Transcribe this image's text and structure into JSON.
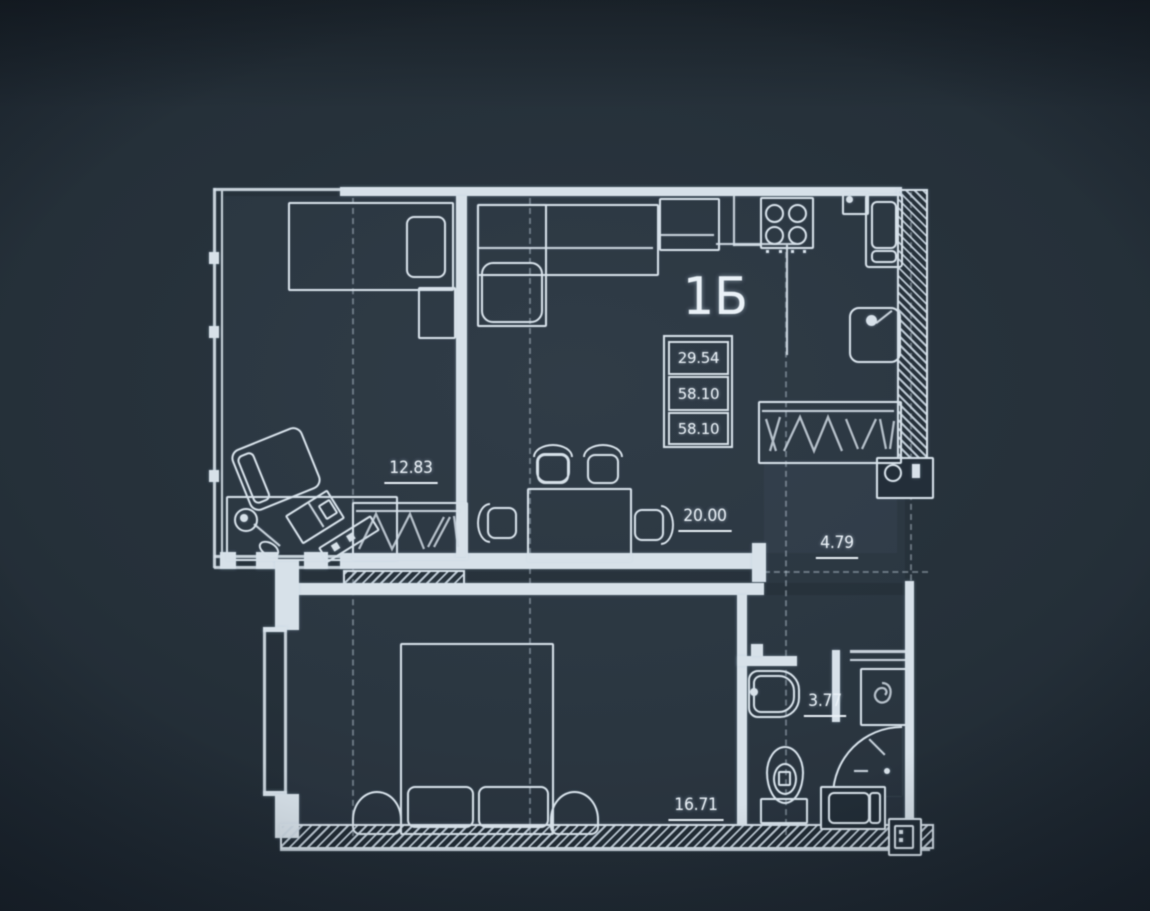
{
  "plan": {
    "unit_label": "1Б",
    "area_table": [
      "29.54",
      "58.10",
      "58.10"
    ],
    "room_areas": {
      "office": "12.83",
      "living": "20.00",
      "hall": "4.79",
      "bathroom": "3.77",
      "bedroom": "16.71"
    },
    "colors": {
      "background_dark": "#121a23",
      "background_mid": "#253039",
      "line": "#d7e1e9",
      "text": "#eaf1f7"
    },
    "icons": [
      "single-bed-icon",
      "double-bed-icon",
      "corner-sofa-icon",
      "dining-table-icon",
      "dining-chair-icon",
      "wardrobe-icon",
      "armchair-icon",
      "desk-icon",
      "desk-lamp-icon",
      "laptop-icon",
      "keyboard-icon",
      "stove-icon",
      "fridge-icon",
      "kitchen-sink-icon",
      "washbasin-icon",
      "toilet-icon",
      "shower-icon",
      "washing-machine-icon",
      "shaft-icon"
    ]
  }
}
